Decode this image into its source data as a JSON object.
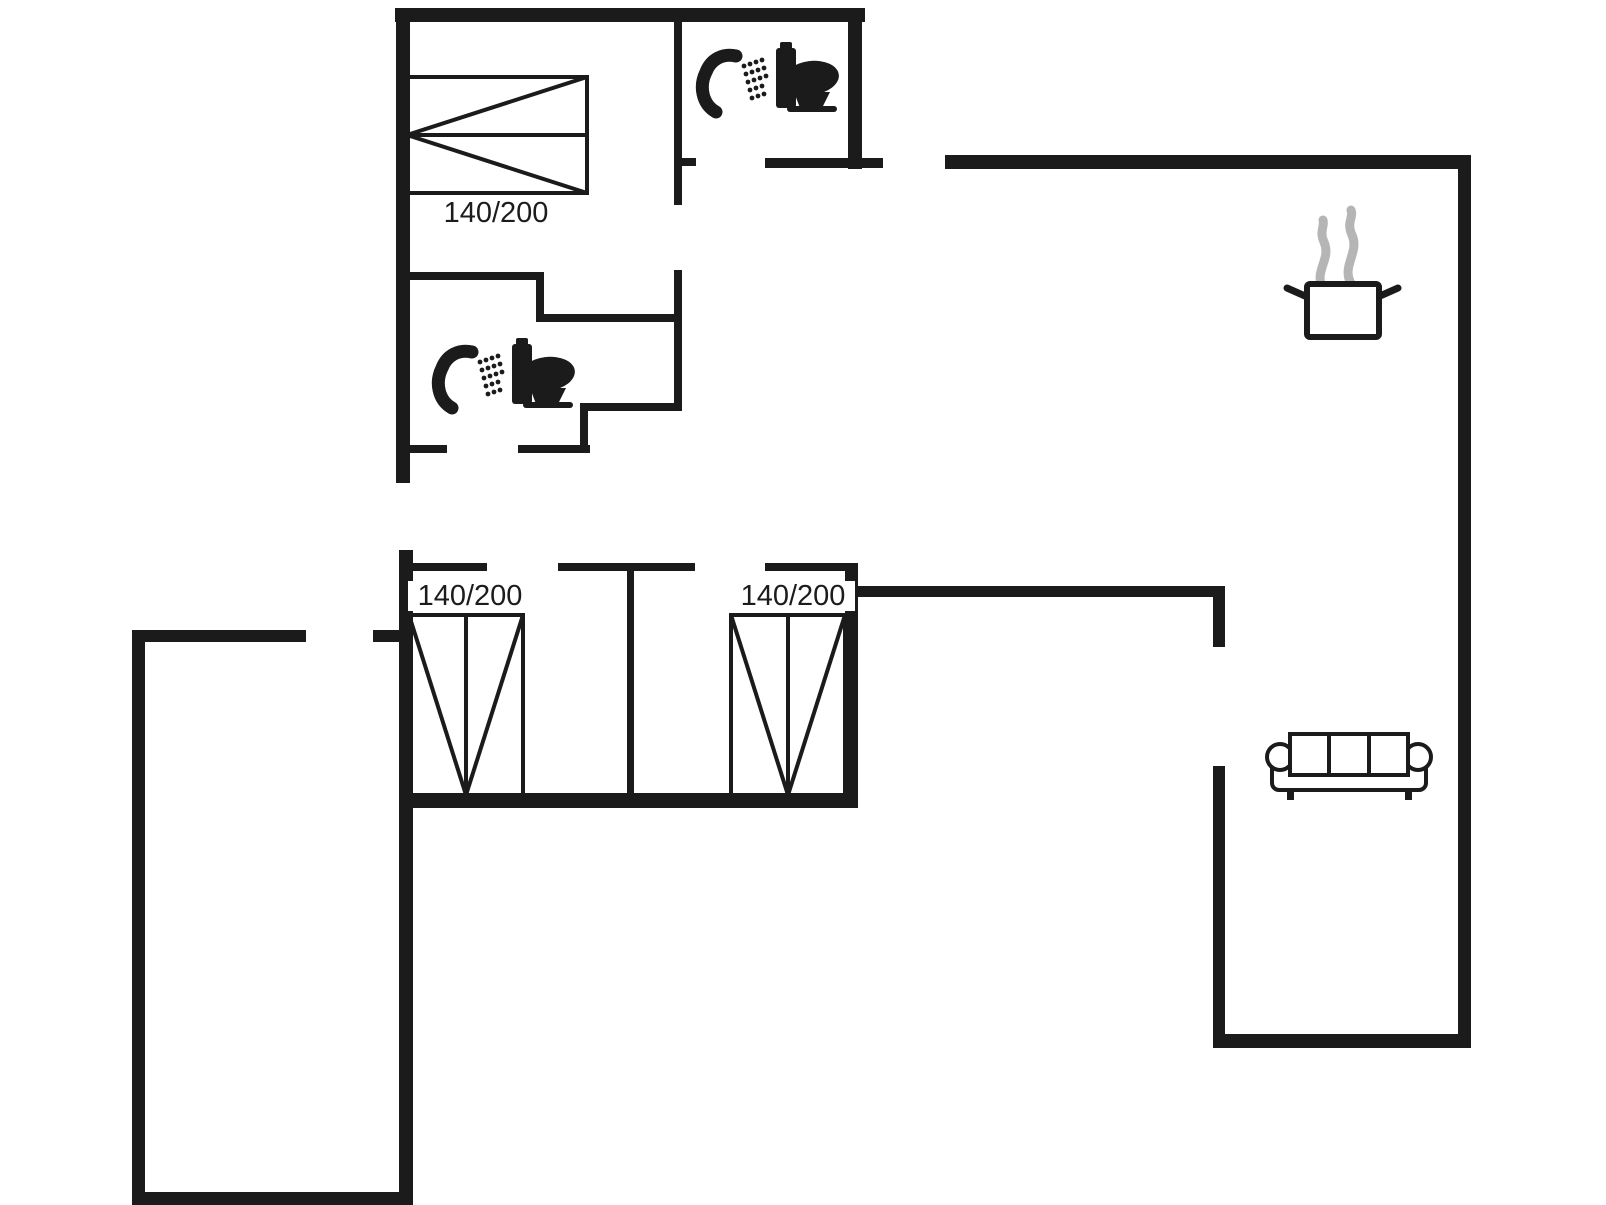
{
  "plan": {
    "type": "house-floor-plan",
    "beds": [
      {
        "id": "bed-top-left",
        "size_label": "140/200",
        "orientation": "horizontal"
      },
      {
        "id": "bed-bottom-left",
        "size_label": "140/200",
        "orientation": "vertical"
      },
      {
        "id": "bed-bottom-middle",
        "size_label": "140/200",
        "orientation": "vertical"
      }
    ],
    "icons": [
      "shower-icon",
      "toilet-icon",
      "shower-icon",
      "toilet-icon",
      "cooking-pot-icon",
      "steam-icon",
      "sofa-icon",
      "double-bed-icon",
      "double-bed-icon",
      "double-bed-icon"
    ],
    "colors": {
      "background": "#ffffff",
      "walls": "#1b1b1b",
      "furniture_lines": "#1b1b1b",
      "steam": "#b5b5b5",
      "label_text": "#1c1c1c"
    }
  }
}
